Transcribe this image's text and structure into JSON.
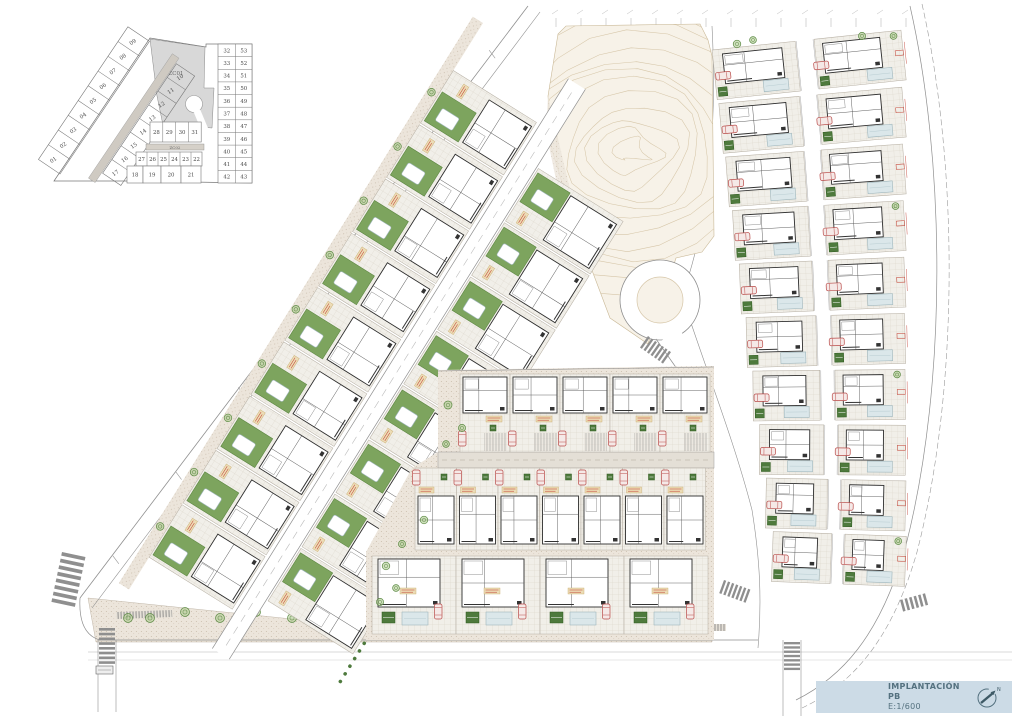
{
  "title_block": {
    "title": "IMPLANTACIÓN PB",
    "scale": "E:1/600",
    "north_label": "N"
  },
  "key_plan": {
    "zone1_label": "ZC01",
    "zone2_label": "ZC02",
    "outer_strip": [
      "01",
      "02",
      "03",
      "04",
      "05",
      "06",
      "07",
      "08",
      "09"
    ],
    "inner_strip": [
      "17",
      "16",
      "15",
      "14",
      "13",
      "12",
      "11",
      "10"
    ],
    "mid_row": [
      "28",
      "29",
      "30",
      "31"
    ],
    "lower_row": [
      "27",
      "26",
      "25",
      "24",
      "23",
      "22"
    ],
    "bottom_row": [
      "18",
      "19",
      "20",
      "21"
    ],
    "right_pairs": [
      [
        "32",
        "53"
      ],
      [
        "33",
        "52"
      ],
      [
        "34",
        "51"
      ],
      [
        "35",
        "50"
      ],
      [
        "36",
        "49"
      ],
      [
        "37",
        "48"
      ],
      [
        "38",
        "47"
      ],
      [
        "39",
        "46"
      ],
      [
        "40",
        "45"
      ],
      [
        "41",
        "44"
      ],
      [
        "42",
        "43"
      ]
    ]
  },
  "site": {
    "left_zone": {
      "outer_units": 9,
      "inner_units": 8
    },
    "middle_zone": {
      "row1_units": 5,
      "row2_units": 7,
      "row3_units": 4
    },
    "right_zone": {
      "rows": 10,
      "cols": 2
    }
  },
  "colors": {
    "lawn": "#7da45e",
    "lawn_stroke": "#5d8742",
    "bush": "#4e7a3d",
    "tree_fill": "#a8c687",
    "tree_stroke": "#5c8a44",
    "pool": "#dbe7ea",
    "pool_stroke": "#9fb6bc",
    "ground": "#ece5db",
    "ground_dot": "#c9bcab",
    "paving": "#f1efe9",
    "paving_line": "#d9d4c8",
    "drive": "#e4dfd6",
    "contour_fill": "#f7f2e8",
    "contour_line": "#d6c6a8",
    "road_line": "#8f8f8f",
    "building_stroke": "#2e2e2e",
    "car_red": "#b94a48",
    "car_fill": "#f5e9e7",
    "dim_red": "#c0392b",
    "label_tan": "#ecdcb6",
    "label_tan_stroke": "#c8a96a",
    "title_bg": "#ccdbe6",
    "title_text": "#54717f",
    "keyplan_line": "#4a4a4a",
    "keyplan_gray": "#d8d8d8",
    "zebra": "#8f8f8f"
  }
}
